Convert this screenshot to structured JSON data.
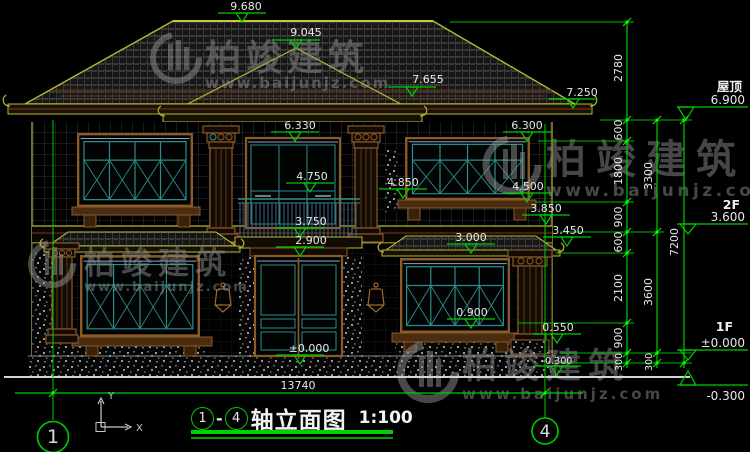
{
  "meta": {
    "drawing_type": "house front elevation, CAD style"
  },
  "colors": {
    "background": "#000000",
    "dimension_green": "#00cc00",
    "grip_green": "#00ff00",
    "roof_edge_yellow": "#b8b832",
    "trim_brown": "#8a5a28",
    "accent_brown": "#7a3a14",
    "window_teal": "#2e8b8b",
    "glass_blue": "#7fa8c8",
    "railing_blue": "#4a6a92",
    "text_white": "#e8e8e8",
    "watermark_gray": "#8e8e8e",
    "title_underline_green": "#00d000"
  },
  "watermark": {
    "brand": "柏竣建筑",
    "url": "www.baijunjz.com"
  },
  "elev": {
    "ridge": "9.680",
    "hip_apex": "9.045",
    "porch_ridge": "7.655",
    "main_eave": "7.250",
    "win2f_center_top": "6.330",
    "win2f_right_top": "6.300",
    "railing_top": "4.850",
    "transom": "4.750",
    "win2f_right_sill": "4.500",
    "belt_top": "3.850",
    "balcony_floor": "3.750",
    "belt_bottom": "3.450",
    "door_top": "2.900",
    "win1f_right_top": "3.000",
    "win1f_right_sill": "0.900",
    "pedestal_top": "0.550",
    "threshold": "±0.000",
    "base_right": "-0.300"
  },
  "levels": {
    "roof_label": "屋顶",
    "roof_value": "6.900",
    "f2_label": "2F",
    "f2_value": "3.600",
    "f1_label": "1F",
    "f1_value": "±0.000",
    "ground_value": "-0.300"
  },
  "dims": {
    "roof_height": "2780",
    "chain": [
      "600",
      "1800",
      "900",
      "600",
      "2100",
      "900",
      "300"
    ],
    "floor_chain": [
      "3300",
      "3600",
      "300"
    ],
    "total": "7200",
    "overall_width": "13740"
  },
  "axes": {
    "left": "1",
    "right": "4"
  },
  "title_block": {
    "from": "1",
    "dash": "-",
    "to": "4",
    "name": "轴立面图",
    "scale": "1:100"
  },
  "ucs": {
    "x": "X",
    "y": "Y"
  }
}
